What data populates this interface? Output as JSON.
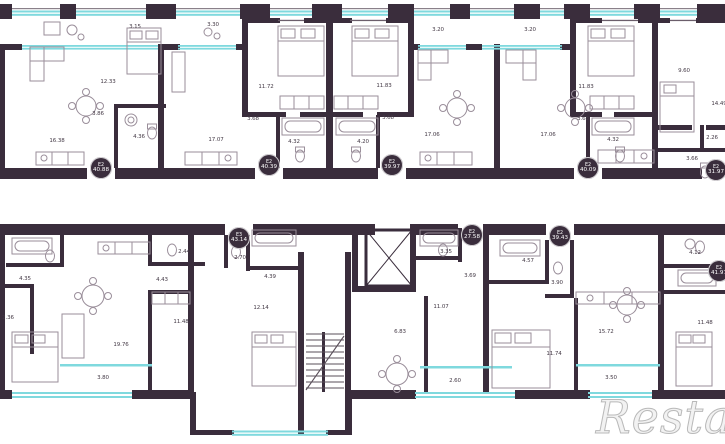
{
  "plan": {
    "watermark": "Restate",
    "badges": [
      {
        "type": "E2",
        "area": "40.88",
        "x": 101,
        "y": 168
      },
      {
        "type": "E2",
        "area": "40.39",
        "x": 269,
        "y": 165
      },
      {
        "type": "E2",
        "area": "39.97",
        "x": 392,
        "y": 165
      },
      {
        "type": "E2",
        "area": "40.09",
        "x": 588,
        "y": 168
      },
      {
        "type": "E2",
        "area": "31.97",
        "x": 716,
        "y": 170
      },
      {
        "type": "E3",
        "area": "43.14",
        "x": 239,
        "y": 238
      },
      {
        "type": "E2",
        "area": "27.58",
        "x": 472,
        "y": 235
      },
      {
        "type": "E2",
        "area": "39.43",
        "x": 560,
        "y": 236
      },
      {
        "type": "E2",
        "area": "41.97",
        "x": 719,
        "y": 271
      }
    ],
    "rooms": [
      {
        "label": "3.15",
        "x": 135,
        "y": 27
      },
      {
        "label": "12.33",
        "x": 108,
        "y": 82
      },
      {
        "label": "16.38",
        "x": 57,
        "y": 141
      },
      {
        "label": "3.86",
        "x": 98,
        "y": 114
      },
      {
        "label": "4.36",
        "x": 139,
        "y": 137
      },
      {
        "label": "3.30",
        "x": 213,
        "y": 25
      },
      {
        "label": "17.07",
        "x": 216,
        "y": 140
      },
      {
        "label": "11.72",
        "x": 266,
        "y": 87
      },
      {
        "label": "3.68",
        "x": 253,
        "y": 119
      },
      {
        "label": "4.32",
        "x": 294,
        "y": 142
      },
      {
        "label": "3.20",
        "x": 438,
        "y": 30
      },
      {
        "label": "11.83",
        "x": 384,
        "y": 86
      },
      {
        "label": "3.68",
        "x": 388,
        "y": 118
      },
      {
        "label": "4.20",
        "x": 363,
        "y": 142
      },
      {
        "label": "17.06",
        "x": 432,
        "y": 135
      },
      {
        "label": "3.20",
        "x": 530,
        "y": 30
      },
      {
        "label": "17.06",
        "x": 548,
        "y": 135
      },
      {
        "label": "11.83",
        "x": 586,
        "y": 87
      },
      {
        "label": "3.68",
        "x": 583,
        "y": 119
      },
      {
        "label": "4.32",
        "x": 613,
        "y": 140
      },
      {
        "label": "9.60",
        "x": 684,
        "y": 71
      },
      {
        "label": "14.49",
        "x": 719,
        "y": 104
      },
      {
        "label": "2.26",
        "x": 712,
        "y": 138
      },
      {
        "label": "3.66",
        "x": 692,
        "y": 159
      },
      {
        "label": "4.35",
        "x": 25,
        "y": 279
      },
      {
        "label": "2.44",
        "x": 184,
        "y": 252
      },
      {
        "label": "2.70",
        "x": 240,
        "y": 258
      },
      {
        "label": "4.43",
        "x": 162,
        "y": 280
      },
      {
        "label": "2.36",
        "x": 8,
        "y": 318
      },
      {
        "label": "19.76",
        "x": 121,
        "y": 345
      },
      {
        "label": "11.48",
        "x": 181,
        "y": 322
      },
      {
        "label": "3.80",
        "x": 103,
        "y": 378
      },
      {
        "label": "4.39",
        "x": 270,
        "y": 277
      },
      {
        "label": "12.14",
        "x": 261,
        "y": 308
      },
      {
        "label": "3.35",
        "x": 446,
        "y": 252
      },
      {
        "label": "3.69",
        "x": 470,
        "y": 276
      },
      {
        "label": "11.07",
        "x": 441,
        "y": 307
      },
      {
        "label": "6.83",
        "x": 400,
        "y": 332
      },
      {
        "label": "2.60",
        "x": 455,
        "y": 381
      },
      {
        "label": "4.57",
        "x": 528,
        "y": 261
      },
      {
        "label": "3.90",
        "x": 557,
        "y": 283
      },
      {
        "label": "11.74",
        "x": 554,
        "y": 354
      },
      {
        "label": "15.72",
        "x": 606,
        "y": 332
      },
      {
        "label": "3.50",
        "x": 611,
        "y": 378
      },
      {
        "label": "4.12",
        "x": 695,
        "y": 253
      },
      {
        "label": "11.48",
        "x": 705,
        "y": 323
      }
    ]
  },
  "colors": {
    "wall": "#3a2d3c",
    "glazing": "#7fd9de",
    "furniture": "#9a8e9a",
    "label_text": "#443a46",
    "badge_bg": "#3a2d3c",
    "badge_text": "#ffffff"
  }
}
